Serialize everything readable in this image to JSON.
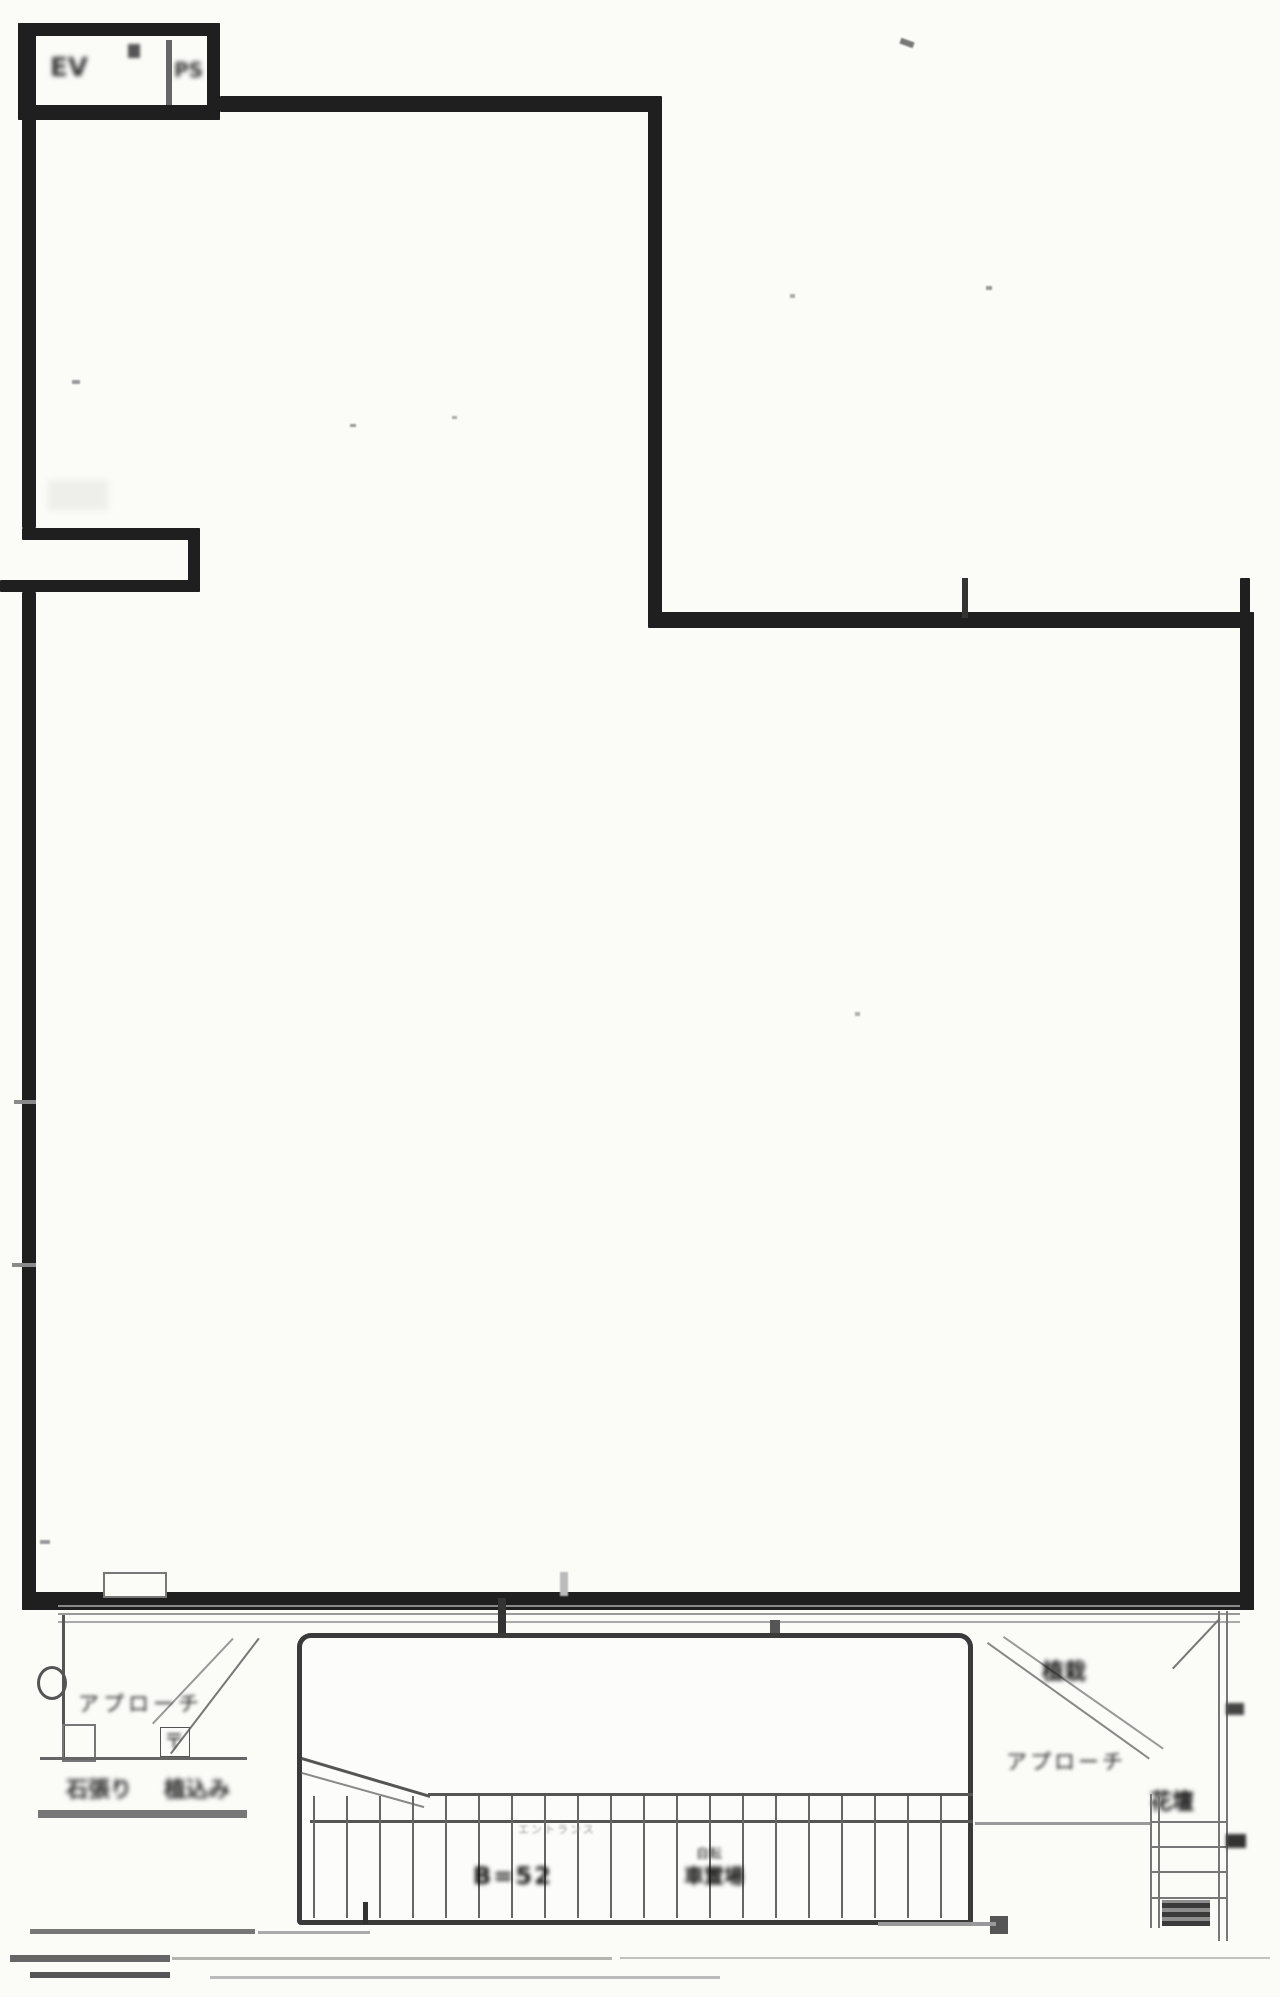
{
  "document": {
    "kind": "scanned architectural floor plan",
    "floor_outline": "L-shaped single large room with top-left shaft annex, left-wall duct notch, stepped upper-right corner, entrance canopy with exterior stairs and approach paths at bottom"
  },
  "labels": {
    "annex_cell_left": "EV",
    "annex_cell_right": "PS",
    "approach_left": "アプローチ",
    "left_utility_glyph": "〒",
    "left_row_text_a": "石張り",
    "left_row_text_b": "植込み",
    "entrance_note": "エントランス",
    "stair_dim": "B=52",
    "bike_line1": "自転",
    "bike_line2": "車置場",
    "planting": "植栽",
    "approach_right": "アプローチ",
    "flower_bed": "花壇"
  },
  "colors": {
    "wall": "#1f1f1f",
    "line_medium": "#555555",
    "line_light": "#8a8a8a",
    "line_faint": "#b5b5b0",
    "paper": "#fbfbf8",
    "ink": "#2a2a2a"
  }
}
